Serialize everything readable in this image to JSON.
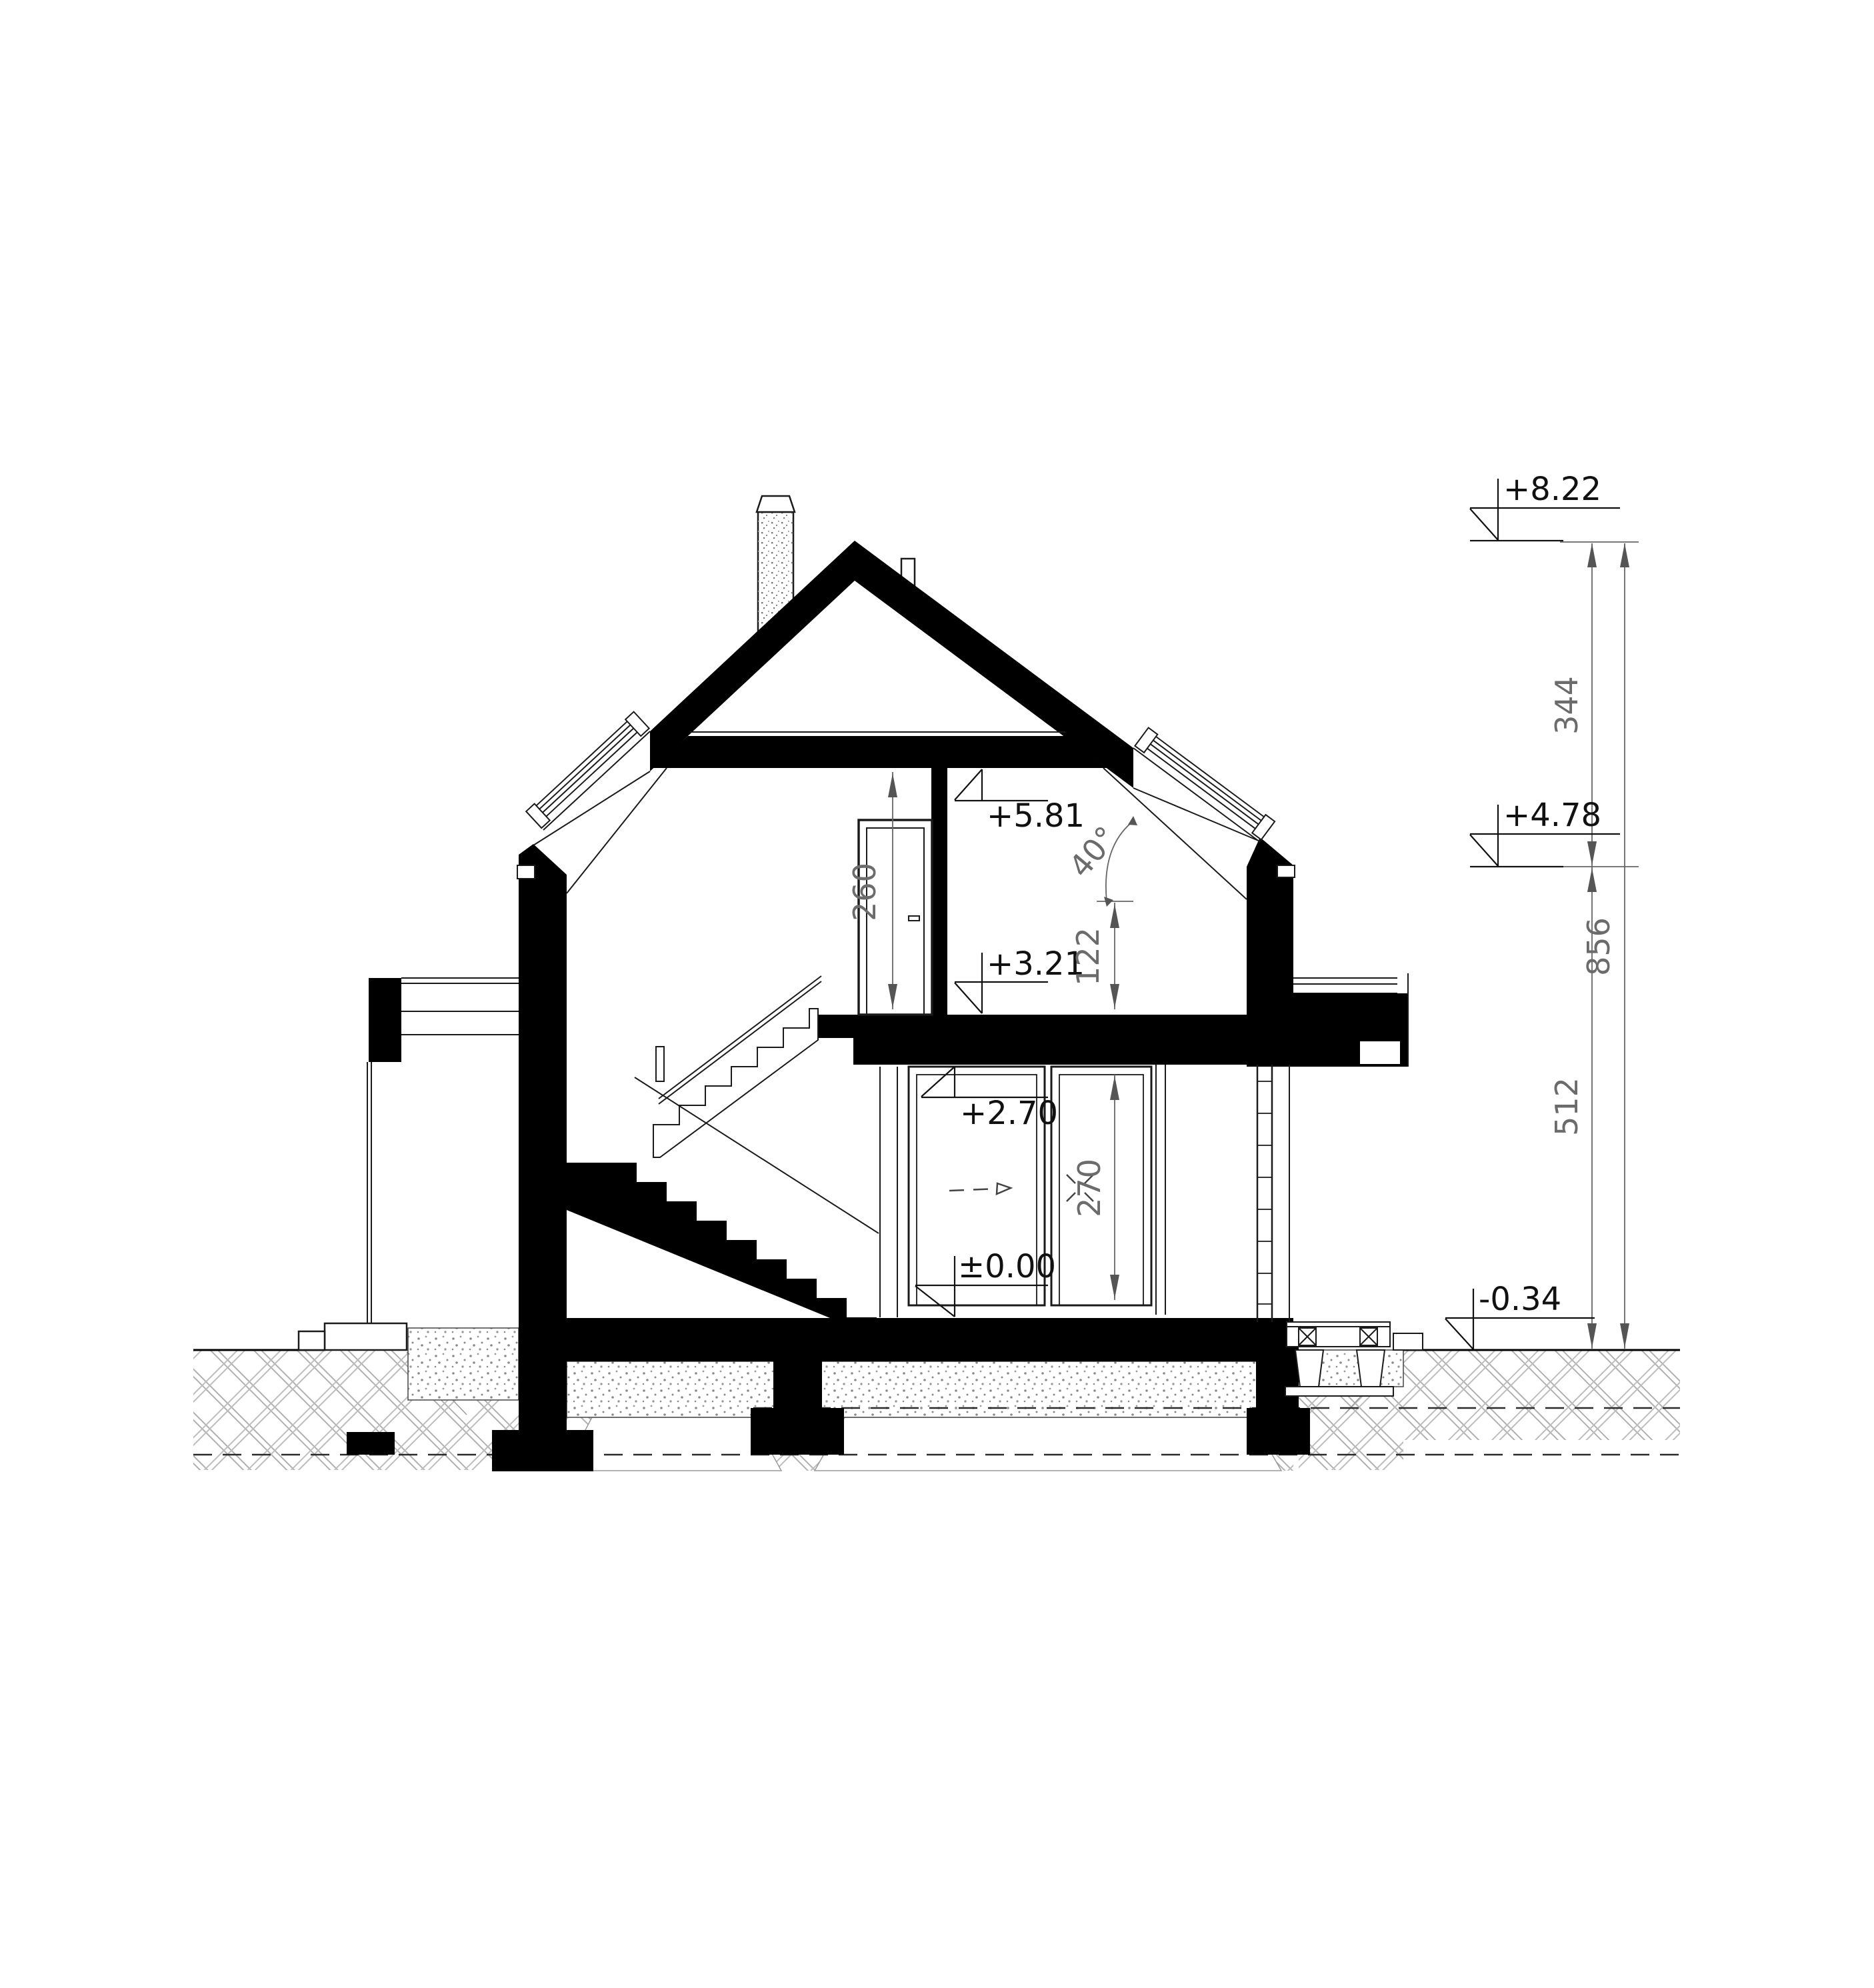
{
  "drawing": {
    "title": "house-cross-section",
    "annotations": {
      "levels": {
        "ridge": "+8.22",
        "eaves": "+4.78",
        "terrain": "-0.34",
        "attic_ceiling": "+5.81",
        "attic_floor": "+3.21",
        "ground_ceiling": "+2.70",
        "ground_floor": "±0.00"
      },
      "dims": {
        "roof_zone": "344",
        "overall": "856",
        "lower_zone": "512",
        "attic_clear": "260",
        "knee_wall": "122",
        "ground_clear": "270",
        "pitch": "40°"
      }
    },
    "colors": {
      "ink": "#000000",
      "thin_line": "#1a1a1a",
      "dim_line": "#666666",
      "dim_text": "#6b6b6b",
      "hatch": "#b0b0b0",
      "stipple": "#8a8a8a"
    }
  }
}
